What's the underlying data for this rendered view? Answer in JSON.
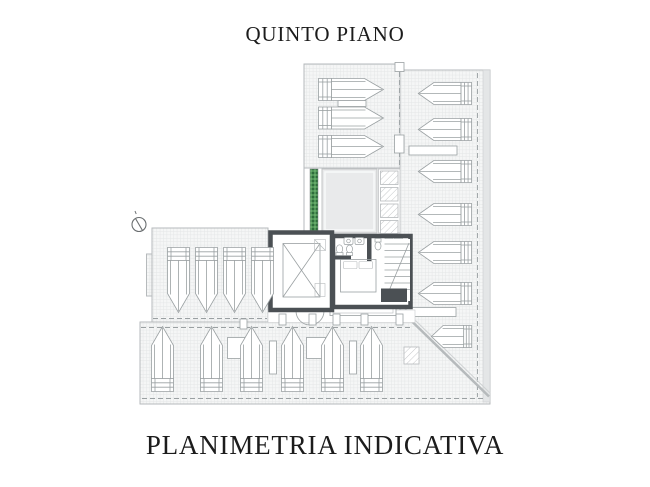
{
  "titles": {
    "top": "QUINTO PIANO",
    "bottom": "PLANIMETRIA INDICATIVA"
  },
  "plan": {
    "lounger_counts": {
      "top_terrace": 3,
      "right_terrace": 7,
      "left_terrace": 4,
      "bottom_terrace": 6
    },
    "features": [
      "sun-loungers",
      "solarium-platform",
      "hedge-planter",
      "skylight-panels",
      "elevator-shaft",
      "staircase",
      "bedroom-with-bathrooms",
      "north-arrow"
    ]
  },
  "colors": {
    "background": "#ffffff",
    "text": "#1c1c1c",
    "line": "#b6babc",
    "line_dark": "#9aa0a2",
    "wall": "#4b5054",
    "deck_fill": "#f5f6f6",
    "deck_grid": "#e4e6e7",
    "solarium": "#e9eaeb",
    "hedge_green": "#4f9657",
    "hedge_green_dark": "#2f6d3c"
  }
}
